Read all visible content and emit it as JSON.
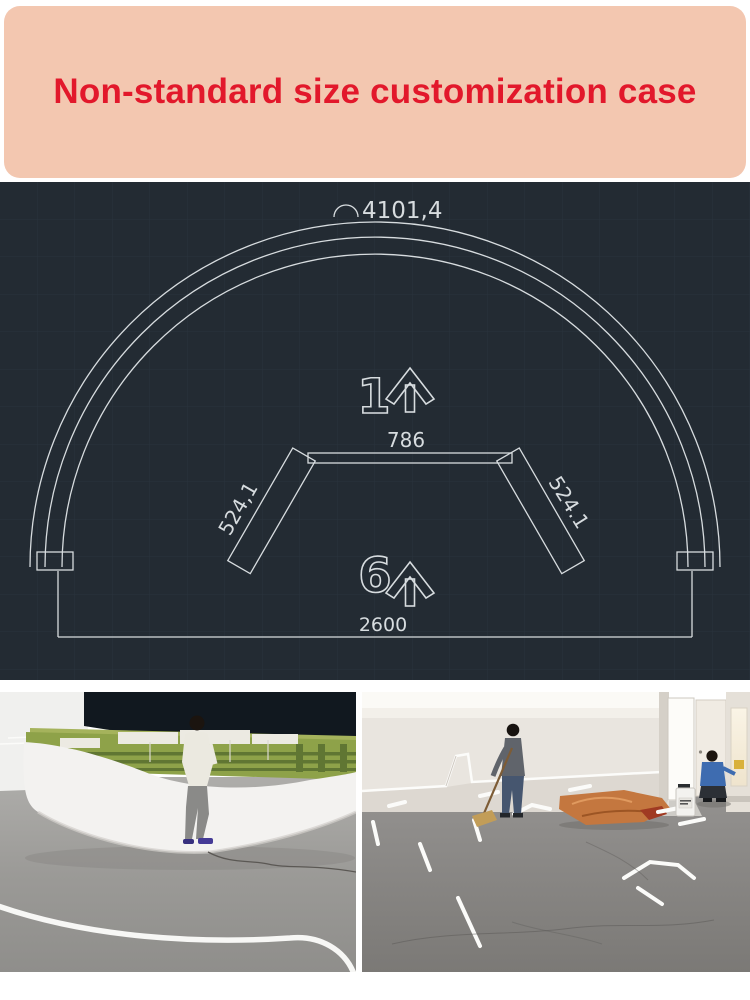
{
  "banner": {
    "title": "Non-standard size customization case",
    "bg_color": "#f3c7b0",
    "text_color": "#e2182b"
  },
  "cad": {
    "bg_color": "#232b33",
    "grid_color": "#2b343d",
    "line_color": "#d7dcdf",
    "labels": {
      "arc_length": "4101,4",
      "top_width": "786",
      "left_length": "524,1",
      "right_length": "524.1",
      "base_width": "2600",
      "qty_top": {
        "count": "1",
        "unit": "个"
      },
      "qty_bottom": {
        "count": "6",
        "unit": "个"
      }
    }
  },
  "photos": {
    "left": {
      "floor_line_color": "#f7f7f5",
      "model_green": "#8ea249",
      "table_color": "#f3f2f0"
    },
    "right": {
      "led_strip_color": "#fbfbf9",
      "tarp_color": "#c4773f",
      "wall_color": "#e9e5df"
    }
  }
}
